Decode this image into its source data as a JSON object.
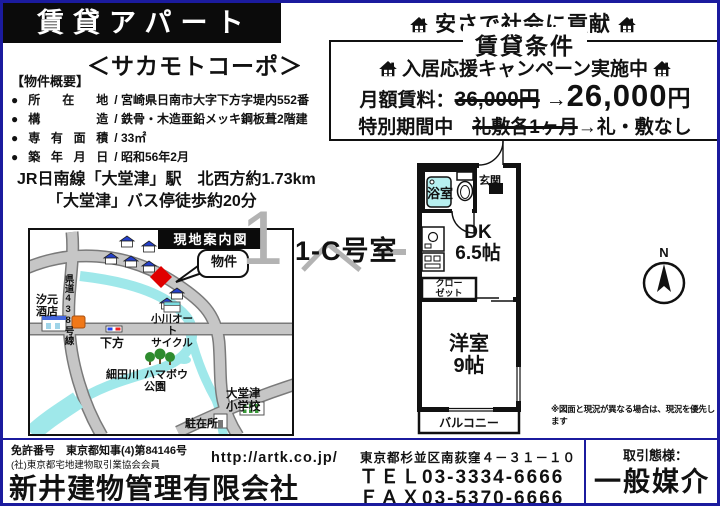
{
  "header": {
    "title": "賃貸アパート",
    "slogan": "安さで社会に貢献"
  },
  "conditions": {
    "box_title": "賃貸条件",
    "campaign": "入居応援キャンペーン実施中",
    "rent_label": "月額賃料：",
    "rent_old": "36,000円",
    "arrow": "→",
    "rent_new_amount": "26,000",
    "rent_new_unit": "円",
    "special_prefix": "特別期間中　",
    "special_old": "礼敷各1ヶ月",
    "special_new": "礼・敷なし"
  },
  "property": {
    "name": "＜サカモトコーポ＞",
    "overview_heading": "【物件概要】",
    "bullet": "●",
    "separator": "/",
    "items": [
      {
        "label": "所在地",
        "value": "宮崎県日南市大字下方字堤内552番"
      },
      {
        "label": "構造",
        "value": "鉄骨・木造亜鉛メッキ鋼板葺2階建"
      },
      {
        "label": "専有面積",
        "value": "33㎡"
      },
      {
        "label": "築年月日",
        "value": "昭和56年2月"
      }
    ],
    "access_line1": "JR日南線「大堂津」駅　北西方約1.73km",
    "access_line2": "「大堂津」バス停徒歩約20分"
  },
  "map": {
    "title": "現地案内図",
    "callout": "物件",
    "labels": {
      "shop1_line1": "汐元",
      "shop1_line2": "酒店",
      "route": "県道438号線",
      "crossing": "下方",
      "cycle_line1": "小川オート",
      "cycle_line2": "サイクル",
      "river": "細田川",
      "park_line1": "ハマボウ",
      "park_line2": "公園",
      "school_line1": "大堂津",
      "school_line2": "小学校",
      "police": "駐在所"
    }
  },
  "unit": {
    "room_no": "1-C号室",
    "watermark": "1"
  },
  "floorplan": {
    "bath": "浴室",
    "entrance": "玄関",
    "dk_label": "DK",
    "dk_size": "6.5帖",
    "closet_line1": "クロー",
    "closet_line2": "ゼット",
    "room_label": "洋室",
    "room_size": "9帖",
    "balcony": "バルコニー",
    "compass": "N",
    "disclaimer": "※図面と現況が異なる場合は、現況を優先します"
  },
  "footer": {
    "license_no": "免許番号　東京都知事(4)第84146号",
    "association": "(社)東京都宅地建物取引業協会会員",
    "url": "http://artk.co.jp/",
    "company": "新井建物管理有限会社",
    "address": "東京都杉並区南荻窪４－３１－１０",
    "tel": "ＴＥＬ03-3334-6666",
    "fax": "ＦＡＸ03-5370-6666",
    "deal_label": "取引態様：",
    "deal_type": "一般媒介"
  },
  "colors": {
    "border_navy": "#1b1b9e",
    "river_cyan": "#9fe8ea",
    "road_gray": "#c6c6c6",
    "marker_red": "#e00000"
  }
}
